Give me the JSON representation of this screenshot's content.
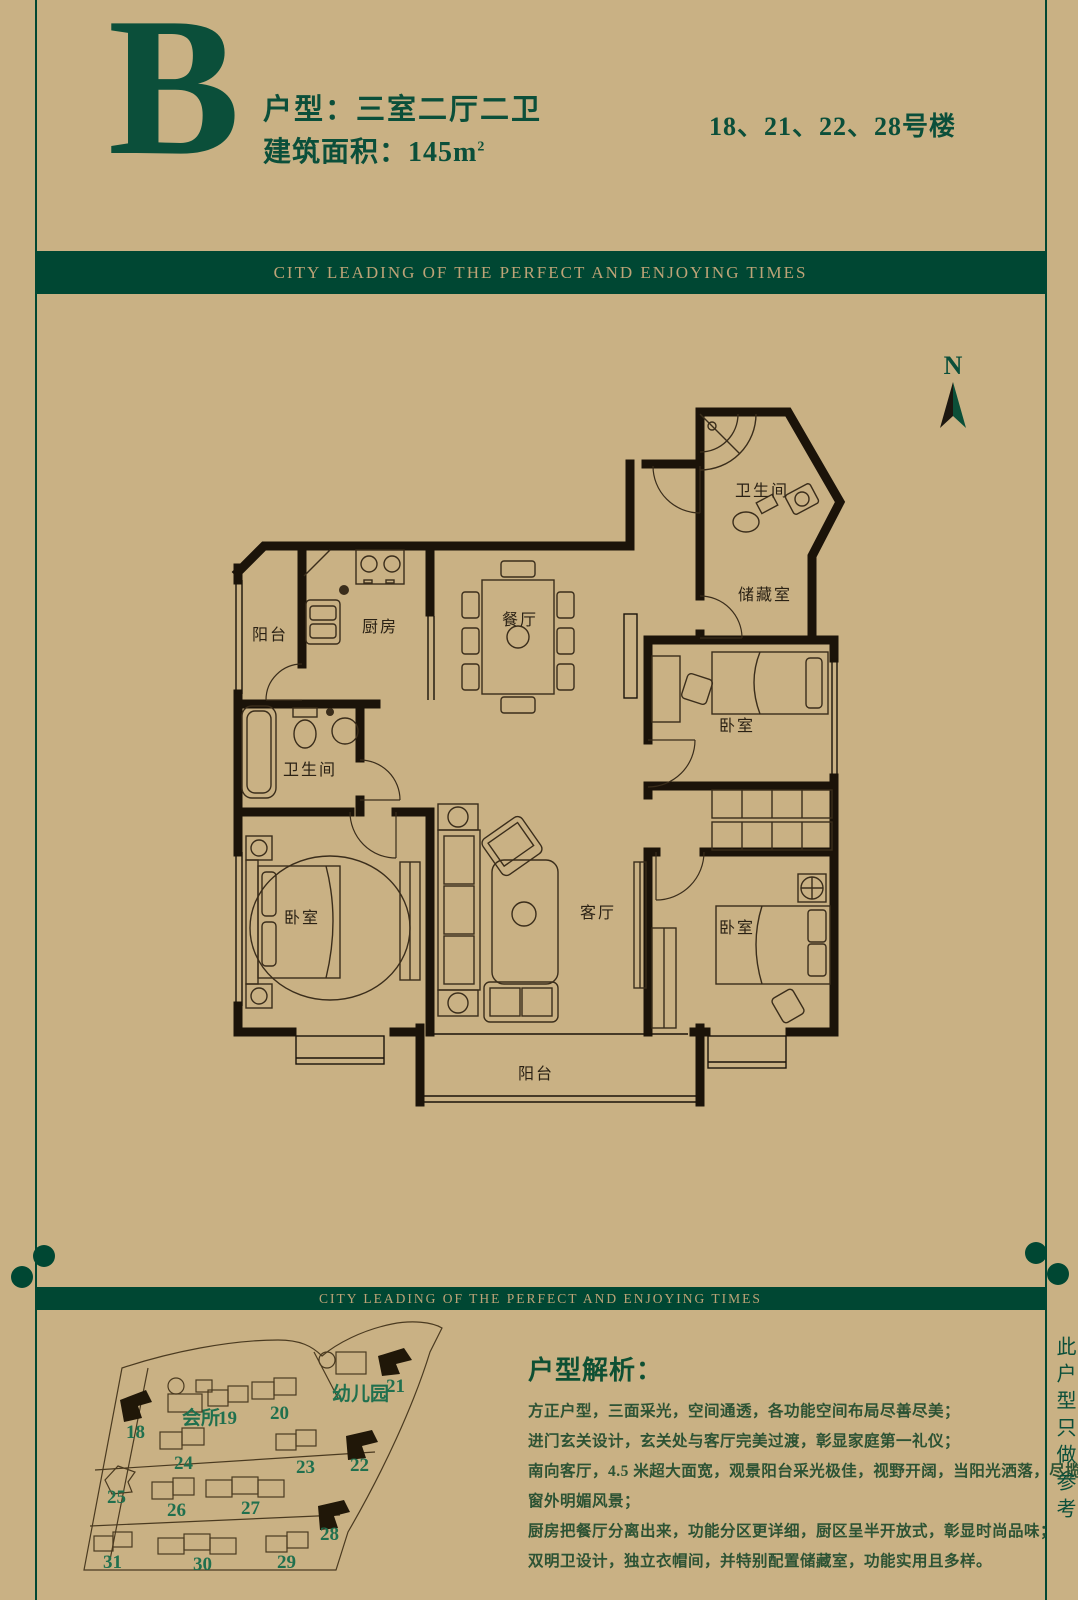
{
  "colors": {
    "background": "#c9b184",
    "deep_green": "#0b4f3a",
    "banner_green": "#004733",
    "banner_gold": "#bda377",
    "wall_black": "#1b1309",
    "site_number_green": "#20704e",
    "highlight_fill": "#201708"
  },
  "header": {
    "letter": "B",
    "type_line": "户型：三室二厅二卫",
    "area_line": "建筑面积：145m",
    "area_sup": "2",
    "buildings": "18、21、22、28号楼"
  },
  "banners": {
    "top": "CITY LEADING OF THE PERFECT AND ENJOYING TIMES",
    "bottom": "CITY LEADING OF THE PERFECT AND ENJOYING TIMES"
  },
  "floor_plan": {
    "north": "N",
    "room_labels": [
      {
        "room": "bathroom-top",
        "text": "卫生间"
      },
      {
        "room": "storage",
        "text": "储藏室"
      },
      {
        "room": "balcony-top",
        "text": "阳台"
      },
      {
        "room": "kitchen",
        "text": "厨房"
      },
      {
        "room": "dining",
        "text": "餐厅"
      },
      {
        "room": "bathroom-left",
        "text": "卫生间"
      },
      {
        "room": "bedroom-left",
        "text": "卧室"
      },
      {
        "room": "living",
        "text": "客厅"
      },
      {
        "room": "bedroom-right-top",
        "text": "卧室"
      },
      {
        "room": "bedroom-right-bottom",
        "text": "卧室"
      },
      {
        "room": "balcony-bottom",
        "text": "阳台"
      }
    ]
  },
  "site_map": {
    "labels": [
      {
        "text": "18",
        "highlighted": true
      },
      {
        "text": "会所",
        "highlighted": false
      },
      {
        "text": "19",
        "highlighted": false
      },
      {
        "text": "20",
        "highlighted": false
      },
      {
        "text": "幼儿园",
        "highlighted": false
      },
      {
        "text": "21",
        "highlighted": true
      },
      {
        "text": "24",
        "highlighted": false
      },
      {
        "text": "23",
        "highlighted": false
      },
      {
        "text": "22",
        "highlighted": true
      },
      {
        "text": "25",
        "highlighted": false
      },
      {
        "text": "26",
        "highlighted": false
      },
      {
        "text": "27",
        "highlighted": false
      },
      {
        "text": "28",
        "highlighted": true
      },
      {
        "text": "31",
        "highlighted": false
      },
      {
        "text": "30",
        "highlighted": false
      },
      {
        "text": "29",
        "highlighted": false
      }
    ]
  },
  "analysis": {
    "title": "户型解析：",
    "lines": [
      "方正户型，三面采光，空间通透，各功能空间布局尽善尽美；",
      "进门玄关设计，玄关处与客厅完美过渡，彰显家庭第一礼仪；",
      "南向客厅，4.5 米超大面宽，观景阳台采光极佳，视野开阔，当阳光洒落，尽揽",
      "窗外明媚风景；",
      "厨房把餐厅分离出来，功能分区更详细，厨区呈半开放式，彰显时尚品味；",
      "双明卫设计，独立衣帽间，并特别配置储藏室，功能实用且多样。"
    ]
  },
  "side_note": "此户型只做参考"
}
